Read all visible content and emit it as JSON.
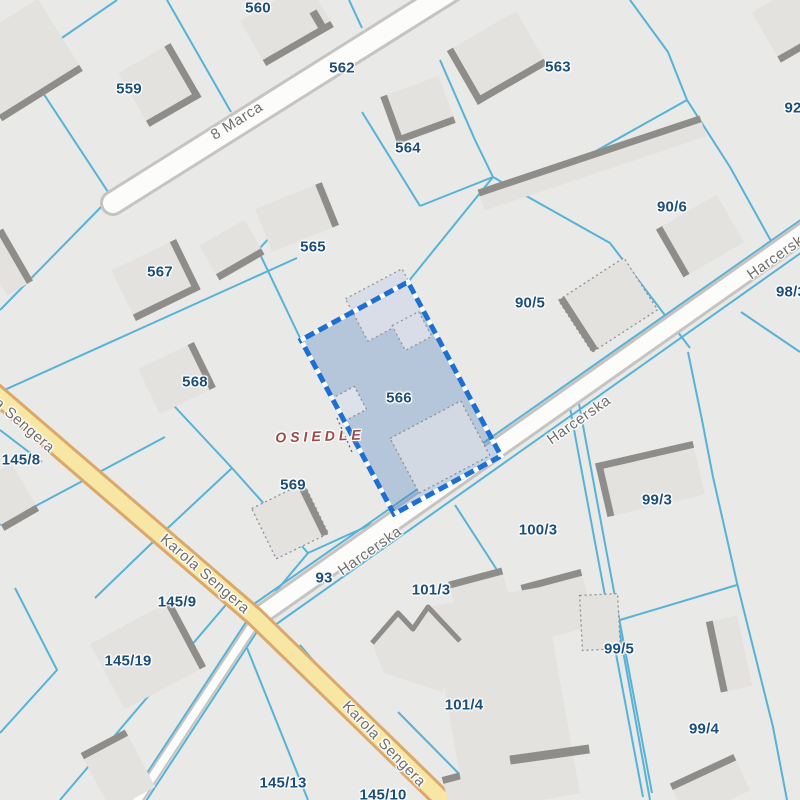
{
  "map": {
    "type": "cadastral-parcel-map",
    "selected_parcel": {
      "id": "566"
    },
    "district_label": "OSIEDLE",
    "streets": {
      "marca": "8 Marca",
      "harcerska": "Harcerska",
      "sengera": "Karola Sengera"
    },
    "parcels": [
      {
        "id": "560"
      },
      {
        "id": "559"
      },
      {
        "id": "562"
      },
      {
        "id": "563"
      },
      {
        "id": "564"
      },
      {
        "id": "92"
      },
      {
        "id": "90/6"
      },
      {
        "id": "565"
      },
      {
        "id": "567"
      },
      {
        "id": "90/5"
      },
      {
        "id": "98/3"
      },
      {
        "id": "568"
      },
      {
        "id": "566"
      },
      {
        "id": "145/8"
      },
      {
        "id": "569"
      },
      {
        "id": "99/3"
      },
      {
        "id": "100/3"
      },
      {
        "id": "93"
      },
      {
        "id": "101/3"
      },
      {
        "id": "145/9"
      },
      {
        "id": "99/5"
      },
      {
        "id": "145/19"
      },
      {
        "id": "101/4"
      },
      {
        "id": "99/4"
      },
      {
        "id": "145/13"
      },
      {
        "id": "145/10"
      }
    ],
    "colors": {
      "background": "#e9e9e8",
      "parcel_line": "#56b3d6",
      "parcel_label": "#1b4e79",
      "street_label": "#6f6e6d",
      "district_label": "#9b4a45",
      "selection_fill": "rgba(77,129,195,0.33)",
      "selection_border": "#1e6fd2",
      "road_fill": "#fcfcfb",
      "road_casing": "#c6c3c0",
      "road_yellow_fill": "#f8e7a4",
      "road_yellow_casing": "#dca86a",
      "building_fill": "#e4e2df",
      "building_edge": "#8f8d8a"
    }
  }
}
